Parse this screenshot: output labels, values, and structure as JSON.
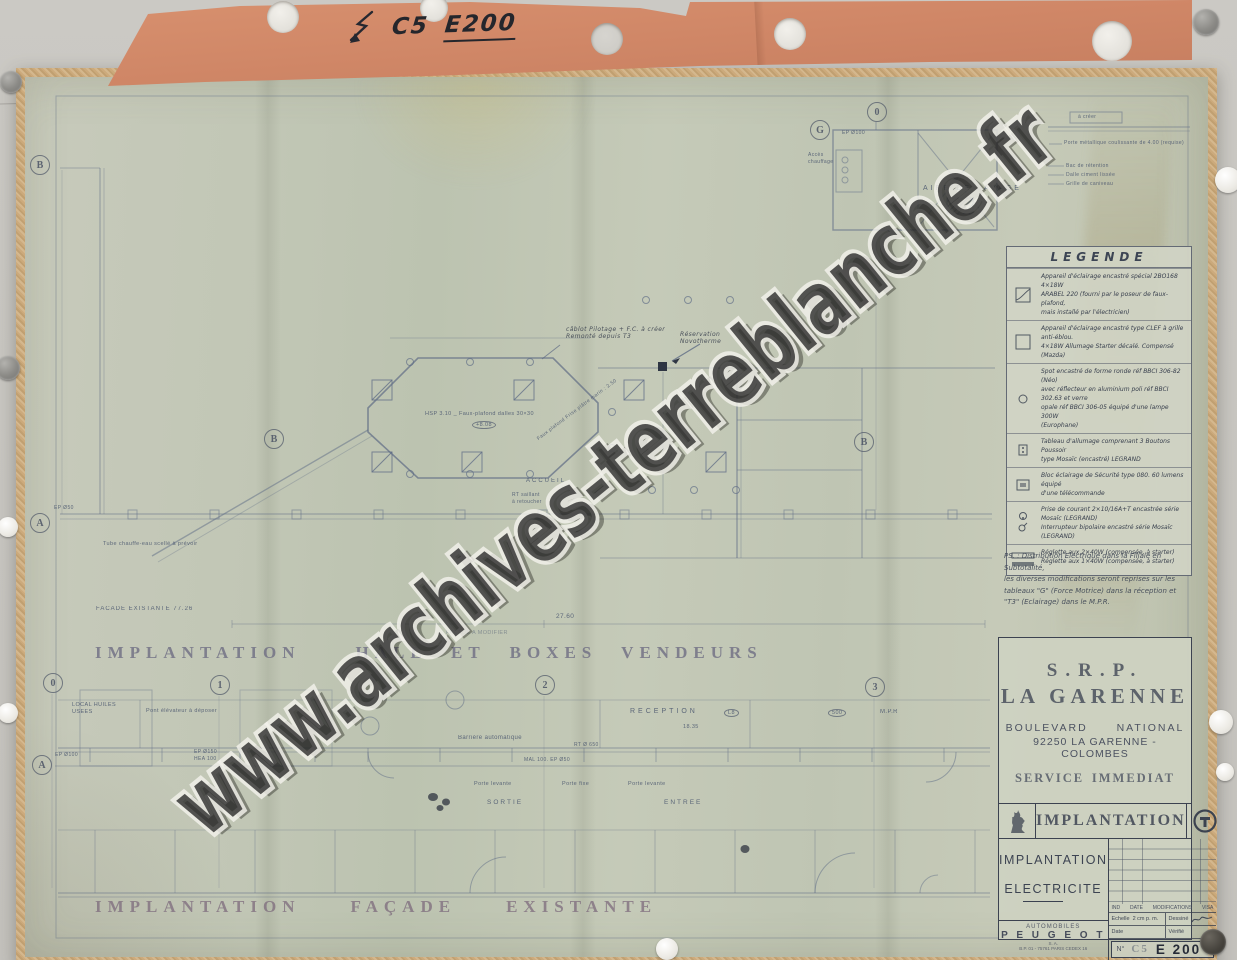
{
  "colors": {
    "board": "#c8c6c1",
    "folder": "#d08767",
    "paper": "#c2c7b6",
    "tape": "#c9a878",
    "ink": "#4d5970",
    "stencil": "#6c6a80"
  },
  "folder": {
    "arrow_icon": "hand-drawn-lightning-arrow",
    "code_prefix": "C5",
    "code_number": "E200"
  },
  "watermark": {
    "text": "www.archives-terreblanche.fr"
  },
  "plan_titles": {
    "hall_left": "IMPLANTATION",
    "hall_right": "HALL  ET  BOXES  VENDEURS",
    "facade_1": "IMPLANTATION",
    "facade_2": "FAÇADE",
    "facade_3": "EXISTANTE",
    "facade_note": "FACADE A MODIFIER"
  },
  "axes": {
    "top_0": "0",
    "g": "G",
    "left_b": "B",
    "left_a": "A",
    "bottom_a": "A",
    "sec_b_left": "B",
    "sec_b_right": "B",
    "ax_0": "0",
    "ax_1": "1",
    "ax_2": "2",
    "ax_3": "3"
  },
  "plan_labels": {
    "aire_de_lavage": "AIRE  DE  LAVAGE",
    "acces_chauffage": [
      "Accès",
      "chauffage"
    ],
    "ep100_top": "EP Ø100",
    "reception": "RECEPTION",
    "tag_l8": "L8",
    "tag_500": "500",
    "mpr": "M.P.R",
    "dim_1835": "18.35",
    "barriere": "Barrière automatique",
    "mal": "MAL 100. EP Ø50",
    "rt650": "RT Ø 650",
    "porte_levante_1": "Porte levante",
    "porte_fixe": "Porte fixe",
    "porte_levante_2": "Porte levante",
    "sortie": "SORTIE",
    "entree": "ENTREE",
    "local_huiles": [
      "LOCAL HUILES",
      "USEES"
    ],
    "pont_elevateur": "Pont élévateur à déposer",
    "ep100_bottom": "EP Ø100",
    "ep150": [
      "EP Ø150",
      "HEA 100"
    ],
    "ep50": "EP Ø50",
    "tube": "Tube chauffe-eau scellé à prévoir",
    "facade_dim": "FACADE  EXISTANTE      77.26",
    "dim_2760": "27.60",
    "faux_plafond": "HSP 3.10 _ Faux-plafond dalles 30×30",
    "cote_808": "+8.08",
    "frise": "Faux plafond Frise plâtre marin : 2.50",
    "accueil": "ACCUEIL",
    "rt_saillant": [
      "RT saillant",
      "à retoucher"
    ],
    "cablot": [
      "câblot Pilotage + F.C.  à créer",
      "Remonté depuis T3"
    ],
    "reservation": [
      "Réservation",
      "Novotherme"
    ]
  },
  "notes_top_right": {
    "header": "à créer",
    "items": [
      "Porte métallique coulissante de 4.00 (requise)",
      "Bac de rétention",
      "Dalle ciment lissée",
      "Grille de caniveau"
    ]
  },
  "legend": {
    "title": "LEGENDE",
    "rows": [
      {
        "symbol": "recessed-special-luminaire",
        "lines": [
          "Appareil d'éclairage encastré spécial 2BO168 4×18W",
          "ARABEL 220 (fourni par le poseur de faux-plafond,",
          "mais installé par l'électricien)"
        ]
      },
      {
        "symbol": "recessed-luminaire",
        "lines": [
          "Appareil d'éclairage encastré type CLEF à grille anti-éblou.",
          "4×18W Allumage Starter décalé. Compensé (Mazda)"
        ]
      },
      {
        "symbol": "round-spot",
        "lines": [
          "Spot encastré de forme ronde réf BBCI 306-82 (Néo)",
          "avec réflecteur en aluminium poli réf BBCI 302.63 et verre",
          "opale réf BBCI 306-05 équipé d'une lampe 300W",
          "(Europhane)"
        ]
      },
      {
        "symbol": "push-button-panel",
        "lines": [
          "Tableau d'allumage comprenant 3 Boutons Poussoir",
          "type Mosaïc (encastré)  LEGRAND"
        ]
      },
      {
        "symbol": "emergency-lighting-block",
        "lines": [
          "Bloc éclairage de Sécurité type 080. 60 lumens équipé",
          "d'une télécommande"
        ]
      },
      {
        "symbol": "socket-and-switch",
        "lines": [
          "Prise de courant 2×10/16A+T encastrée série Mosaïc (LEGRAND)",
          "Interrupteur bipolaire encastré série Mosaïc (LEGRAND)"
        ]
      },
      {
        "symbol": "batten-luminaires",
        "lines": [
          "Réglette aux 2×40W (compensée, à starter)",
          "Réglette aux 1×40W (compensée, à starter)"
        ]
      }
    ]
  },
  "ps_note": {
    "lines": [
      "PS. :  Distribution Electrique dans la Filiale en Subtotalité,",
      "les diverses modifications seront reprises sur les",
      "tableaux \"G\" (Force Motrice) dans la réception et",
      "\"T3\" (Eclairage) dans le M.P.R."
    ]
  },
  "title_block": {
    "org": "S.R.P.",
    "site": "LA GARENNE",
    "address_line1": "BOULEVARD NATIONAL",
    "address_line2": "92250 LA GARENNE - COLOMBES",
    "stamp_left": "SERVICE",
    "stamp_right": "IMMEDIAT",
    "band_title": "IMPLANTATION",
    "subject_line1": "IMPLANTATION",
    "subject_line2": "ELECTRICITE",
    "mods_headers": [
      "IND",
      "DATE",
      "MODIFICATIONS",
      "VISA"
    ],
    "echelle_label": "Echelle",
    "echelle_value": "2 cm  p. m.",
    "dessine_label": "Dessiné",
    "date_label": "Date",
    "verifie_label": "Vérifié",
    "maker_small": "AUTOMOBILES",
    "maker_name": "P E U G E O T",
    "maker_sub": "S. A.",
    "maker_address": "B.P. 01 - 75761 PARIS CEDEX 16",
    "number_prefix": "N°",
    "number_c5": "C5",
    "number_e": "E 200"
  }
}
